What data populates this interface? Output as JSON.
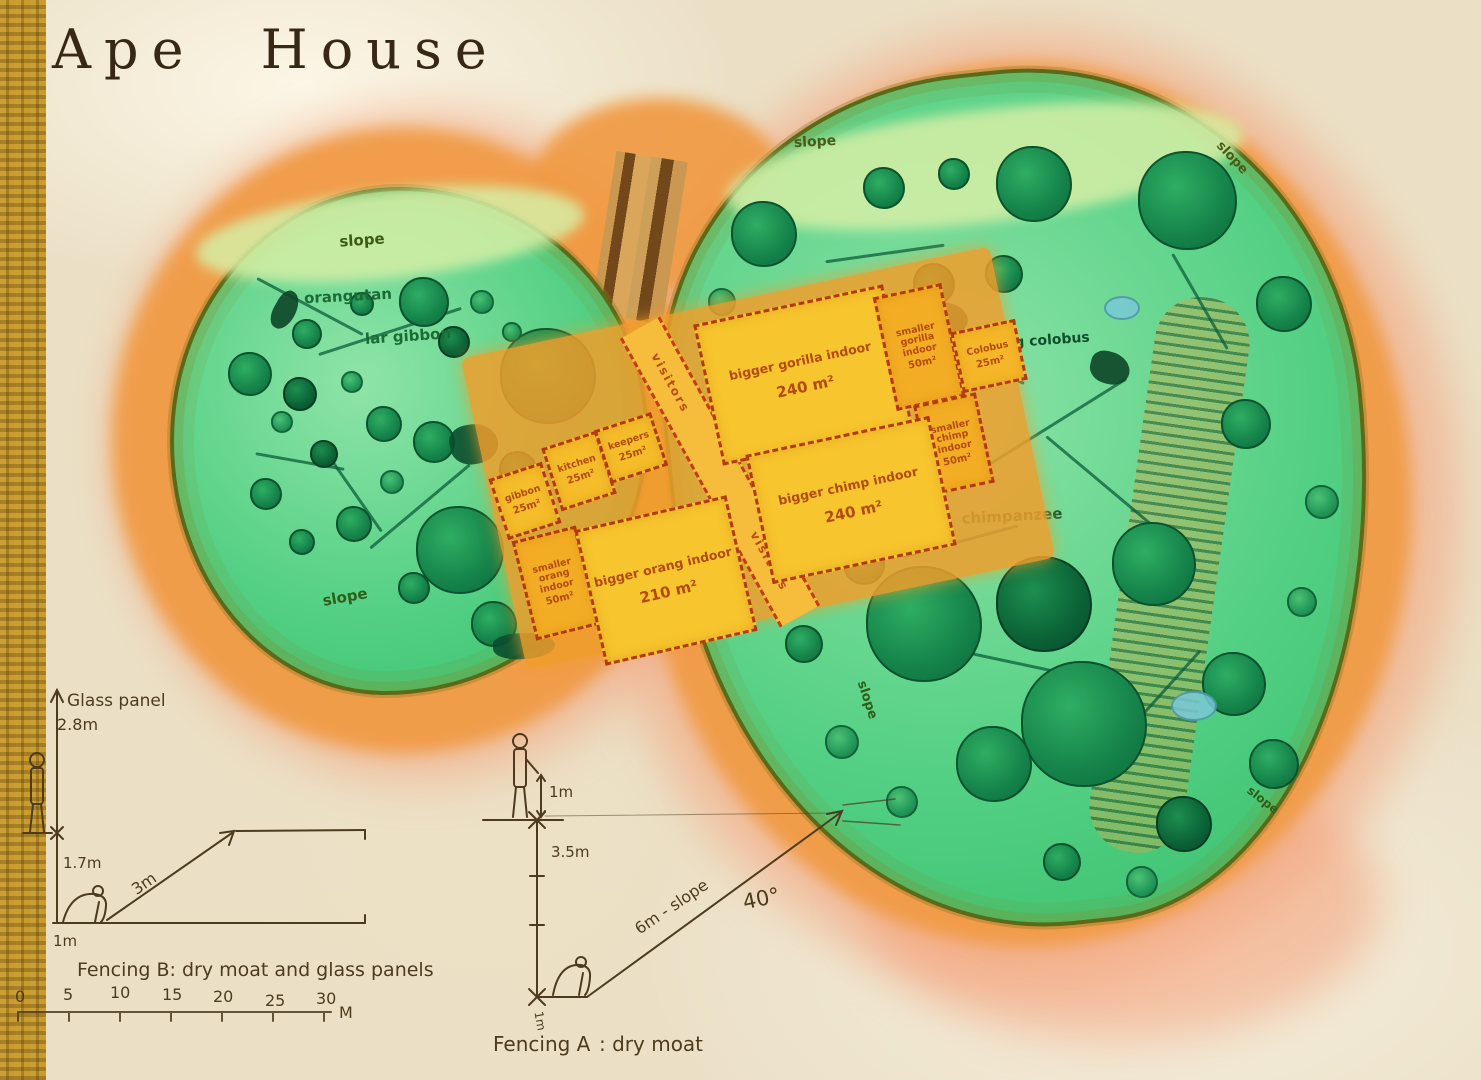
{
  "title": "Ape House",
  "colors": {
    "paper": "#ebe0c6",
    "fabric_gold": "#c2922c",
    "moat_orange": "#f09a44",
    "outer_pink": "#f3a680",
    "enclosure_green": "#54d084",
    "tree_green": "#1f9a55",
    "building_yellow": "#f6c62c",
    "building_orange": "#efa02f",
    "wall_red": "#b33a0e",
    "ink_brown": "#4d3b1e",
    "label_green": "#0e5a35",
    "room_text": "#b34a0e"
  },
  "enclosures": {
    "left": {
      "slope_top": "slope",
      "species_1": "orangutan",
      "species_2": "lar gibbon",
      "slope_bottom": "slope"
    },
    "right": {
      "slope_top": "slope",
      "slope_top_right": "slope",
      "species_1": "king colobus",
      "species_2": "chimpanzee",
      "slope_bottom_left": "slope",
      "slope_bottom_right": "slope"
    }
  },
  "building": {
    "corridor_label": "visitors",
    "rooms": [
      {
        "name": "bigger gorilla indoor",
        "area": "240 m²"
      },
      {
        "name": "smaller gorilla indoor",
        "area": "50m²"
      },
      {
        "name": "Colobus",
        "area": "25m²"
      },
      {
        "name": "smaller chimp indoor",
        "area": "50m²"
      },
      {
        "name": "bigger chimp indoor",
        "area": "240 m²"
      },
      {
        "name": "gibbon",
        "area": "25m²"
      },
      {
        "name": "kitchen",
        "area": "25m²"
      },
      {
        "name": "keepers",
        "area": "25m²"
      },
      {
        "name": "smaller orang indoor",
        "area": "50m²"
      },
      {
        "name": "bigger orang indoor",
        "area": "210 m²"
      }
    ]
  },
  "fencing_b": {
    "glass_label": "Glass panel",
    "glass_height": "2.8m",
    "moat_depth": "1.7m",
    "slope_width": "3m",
    "ledge": "1m",
    "caption": "Fencing B: dry moat and glass panels"
  },
  "scale_bar": {
    "ticks": [
      "0",
      "5",
      "10",
      "15",
      "20",
      "25",
      "30"
    ],
    "unit": "M"
  },
  "fencing_a": {
    "head_clearance": "1m",
    "moat_depth": "3.5m",
    "slope_label": "6m - slope",
    "angle": "40°",
    "ledge": "1m",
    "caption_strong": "Fencing A",
    "caption_rest": ": dry moat"
  }
}
